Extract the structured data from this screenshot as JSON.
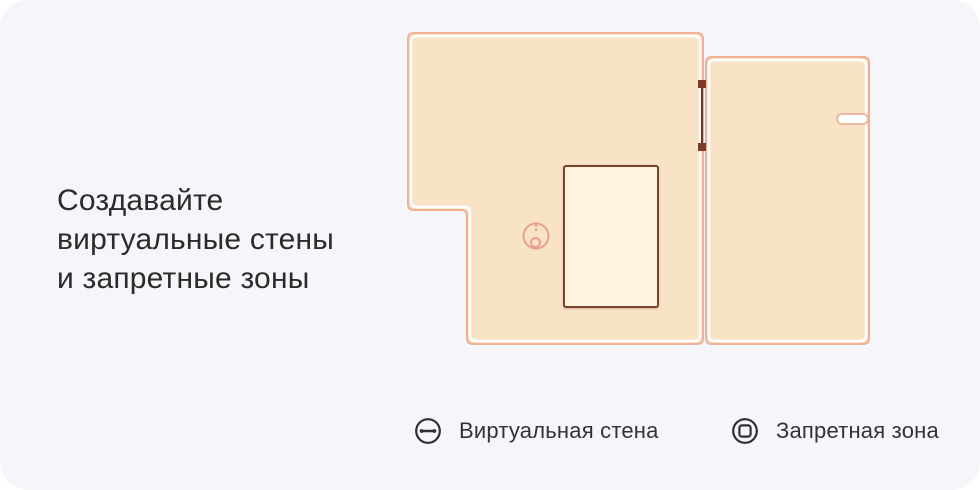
{
  "title": {
    "text": "Создавайте\nвиртуальные стены\nи запретные зоны"
  },
  "legend": {
    "virtual_wall": {
      "label": "Виртуальная стена",
      "icon": "wall-line-in-circle-icon"
    },
    "no_go_zone": {
      "label": "Запретная зона",
      "icon": "square-in-circle-icon"
    }
  },
  "map": {
    "icons": {
      "robot": "robot-vacuum-top-view-icon",
      "virtual_wall": "virtual-wall-segment",
      "no_go_zone": "no-go-zone-rectangle"
    }
  },
  "colors": {
    "background": "#f6f6fa",
    "text": "#2b2b2b",
    "room_fill": "#f9e3c7",
    "room_border": "#f1af94",
    "room_inner_stroke": "#ffffff",
    "no_go_fill": "#fdf3e1",
    "no_go_border": "#7a432e",
    "virtual_wall_line": "#6e3425",
    "virtual_wall_endpoint": "#7d3b2a",
    "robot": "#e89e90",
    "legend_icon": "#2f2f2f",
    "legend_text": "#333333"
  }
}
